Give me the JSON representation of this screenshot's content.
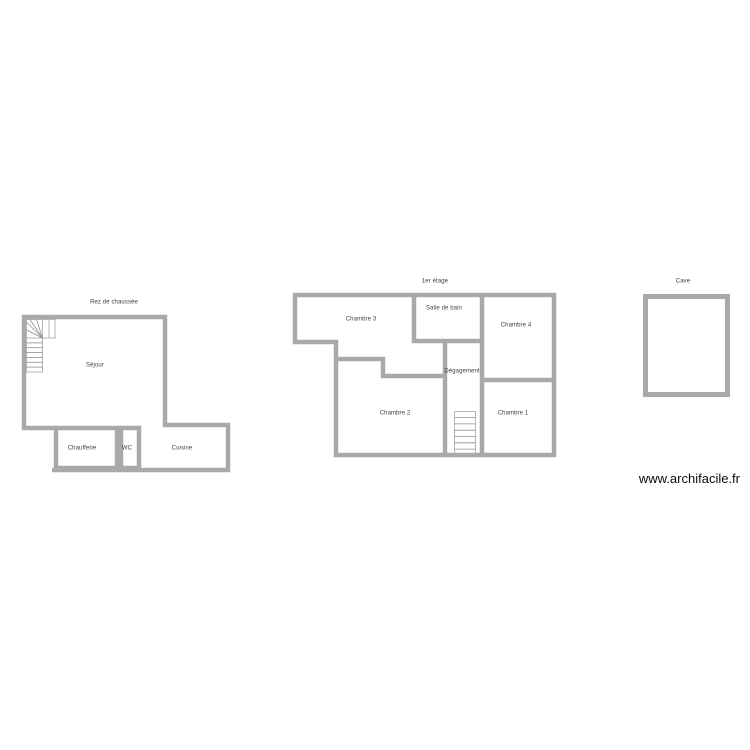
{
  "page": {
    "background_color": "#ffffff",
    "wall_color": "#a9a9a9",
    "stair_outline_color": "#b4b4b4",
    "stair_tread_color": "#8f8f8f",
    "label_color": "#404040",
    "watermark_color": "#0b0b0b"
  },
  "floors": {
    "ground": {
      "title": "Rez de chaussée",
      "rooms": {
        "sejour": {
          "name": "Séjour"
        },
        "chaufferie": {
          "name": "Chaufferie"
        },
        "wc": {
          "name": "WC"
        },
        "cuisine": {
          "name": "Cuisine"
        }
      }
    },
    "first": {
      "title": "1er étage",
      "rooms": {
        "chambre3": {
          "name": "Chambre 3"
        },
        "salle_de_bain": {
          "name": "Salle de bain"
        },
        "chambre4": {
          "name": "Chambre 4"
        },
        "degagement": {
          "name": "Dégagement"
        },
        "chambre2": {
          "name": "Chambre 2"
        },
        "chambre1": {
          "name": "Chambre 1"
        }
      }
    },
    "cellar": {
      "title": "Cave"
    }
  },
  "icons": {
    "ground_staircase": "staircase-icon",
    "first_staircase": "staircase-icon"
  },
  "watermark": {
    "text": "www.archifacile.fr"
  }
}
